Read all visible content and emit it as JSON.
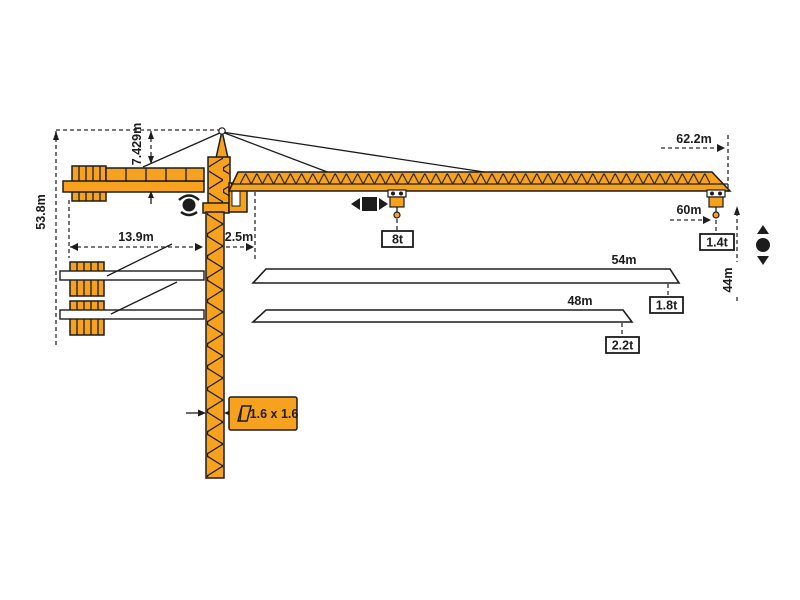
{
  "diagram": {
    "title": "tower-crane-working-range-diagram",
    "colors": {
      "crane_orange": "#F6A21E",
      "outline_black": "#1C1C1C",
      "dimension_gray": "#2B2B2B",
      "background": "#FFFFFF"
    },
    "dims": {
      "total_height": "53.8m",
      "head_height": "7.429m",
      "counterjib_radius": "13.9m",
      "jib_root_offset": "2.5m",
      "max_radius": "62.2m",
      "hook_radius": "60m",
      "hook_drop": "44m",
      "mast_section": "1.6 x 1.6"
    },
    "loads": {
      "max_load": "8t",
      "tip_load": "1.4t"
    },
    "alt_jibs": [
      {
        "length": "54m",
        "tip_load": "1.8t"
      },
      {
        "length": "48m",
        "tip_load": "2.2t"
      }
    ],
    "icons": {
      "slewing": "slewing-icon",
      "trolley_travel": "trolley-travel-icon",
      "hoist": "hoist-icon",
      "cross_section": "cross-section-icon"
    }
  }
}
